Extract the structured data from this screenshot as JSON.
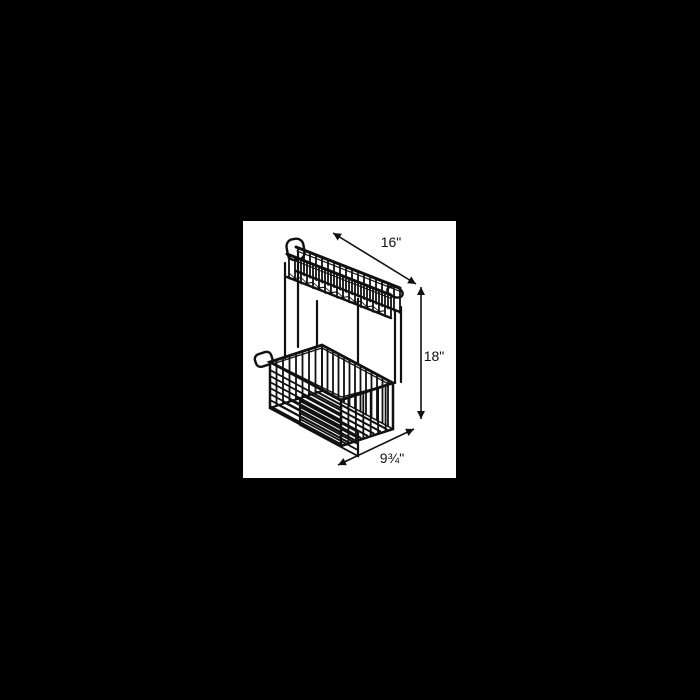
{
  "window": {
    "background_color": "#000000",
    "panel_color": "#ffffff",
    "line_color": "#111111"
  },
  "diagram": {
    "subject": "Two-tier wire corner basket line drawing",
    "dimensions": {
      "width": "16\"",
      "height": "18\"",
      "depth": "9¾\""
    }
  }
}
